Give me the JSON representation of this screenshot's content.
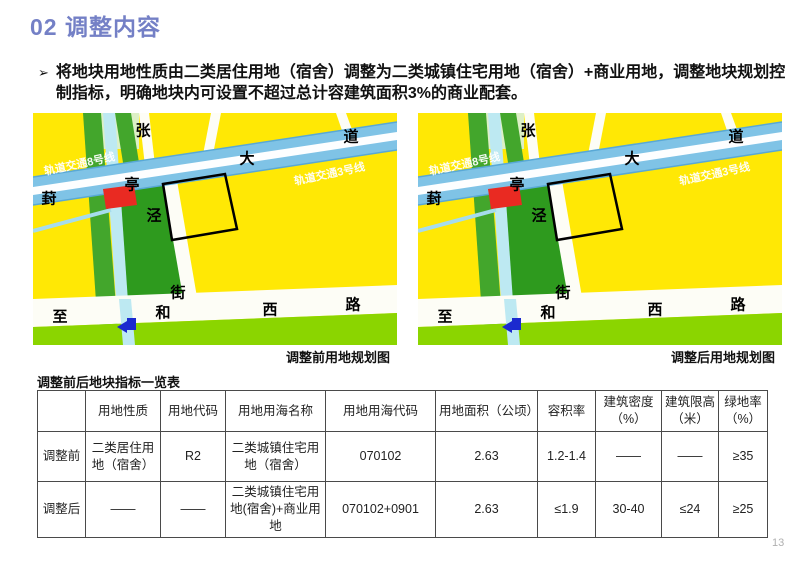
{
  "title": "02 调整内容",
  "bullet": {
    "marker": "➢",
    "text": "将地块用地性质由二类居住用地（宿舍）调整为二类城镇住宅用地（宿舍）+商业用地，调整地块规划控制指标，明确地块内可设置不超过总计容建筑面积3%的商业配套。"
  },
  "maps": {
    "captions": {
      "before": "调整前用地规划图",
      "after": "调整后用地规划图"
    },
    "rail_labels": {
      "line8": "轨道交通8号线",
      "line3": "轨道交通3号线"
    },
    "road_labels": {
      "zhang": "张",
      "dao": "道",
      "da": "大",
      "ting": "亭",
      "feng": "葑",
      "jing": "泾",
      "jie": "街",
      "zhi": "至",
      "he": "和",
      "xi": "西",
      "lu": "路"
    }
  },
  "table": {
    "title": "调整前后地块指标一览表",
    "headers": [
      "",
      "用地性质",
      "用地代码",
      "用地用海名称",
      "用地用海代码",
      "用地面积（公顷）",
      "容积率",
      "建筑密度（%）",
      "建筑限高（米）",
      "绿地率（%）"
    ],
    "rows": [
      {
        "label": "调整前",
        "cells": [
          "二类居住用地（宿舍）",
          "R2",
          "二类城镇住宅用地（宿舍）",
          "070102",
          "2.63",
          "1.2-1.4",
          "——",
          "——",
          "≥35"
        ]
      },
      {
        "label": "调整后",
        "cells": [
          "——",
          "——",
          "二类城镇住宅用地(宿舍)+商业用地",
          "070102+0901",
          "2.63",
          "≤1.9",
          "30-40",
          "≤24",
          "≥25"
        ]
      }
    ]
  },
  "page": {
    "number": "13"
  },
  "colors": {
    "title_accent": "#7480C6",
    "map_yellow": "#FFE805",
    "map_park_green": "#2E9A1E",
    "map_grass_green": "#8BD500",
    "rail_blue": "#7FC3E6",
    "canal_blue": "#BDE9F2",
    "red_parcel": "#E92A22",
    "metro_blue": "#1B2ACF"
  }
}
